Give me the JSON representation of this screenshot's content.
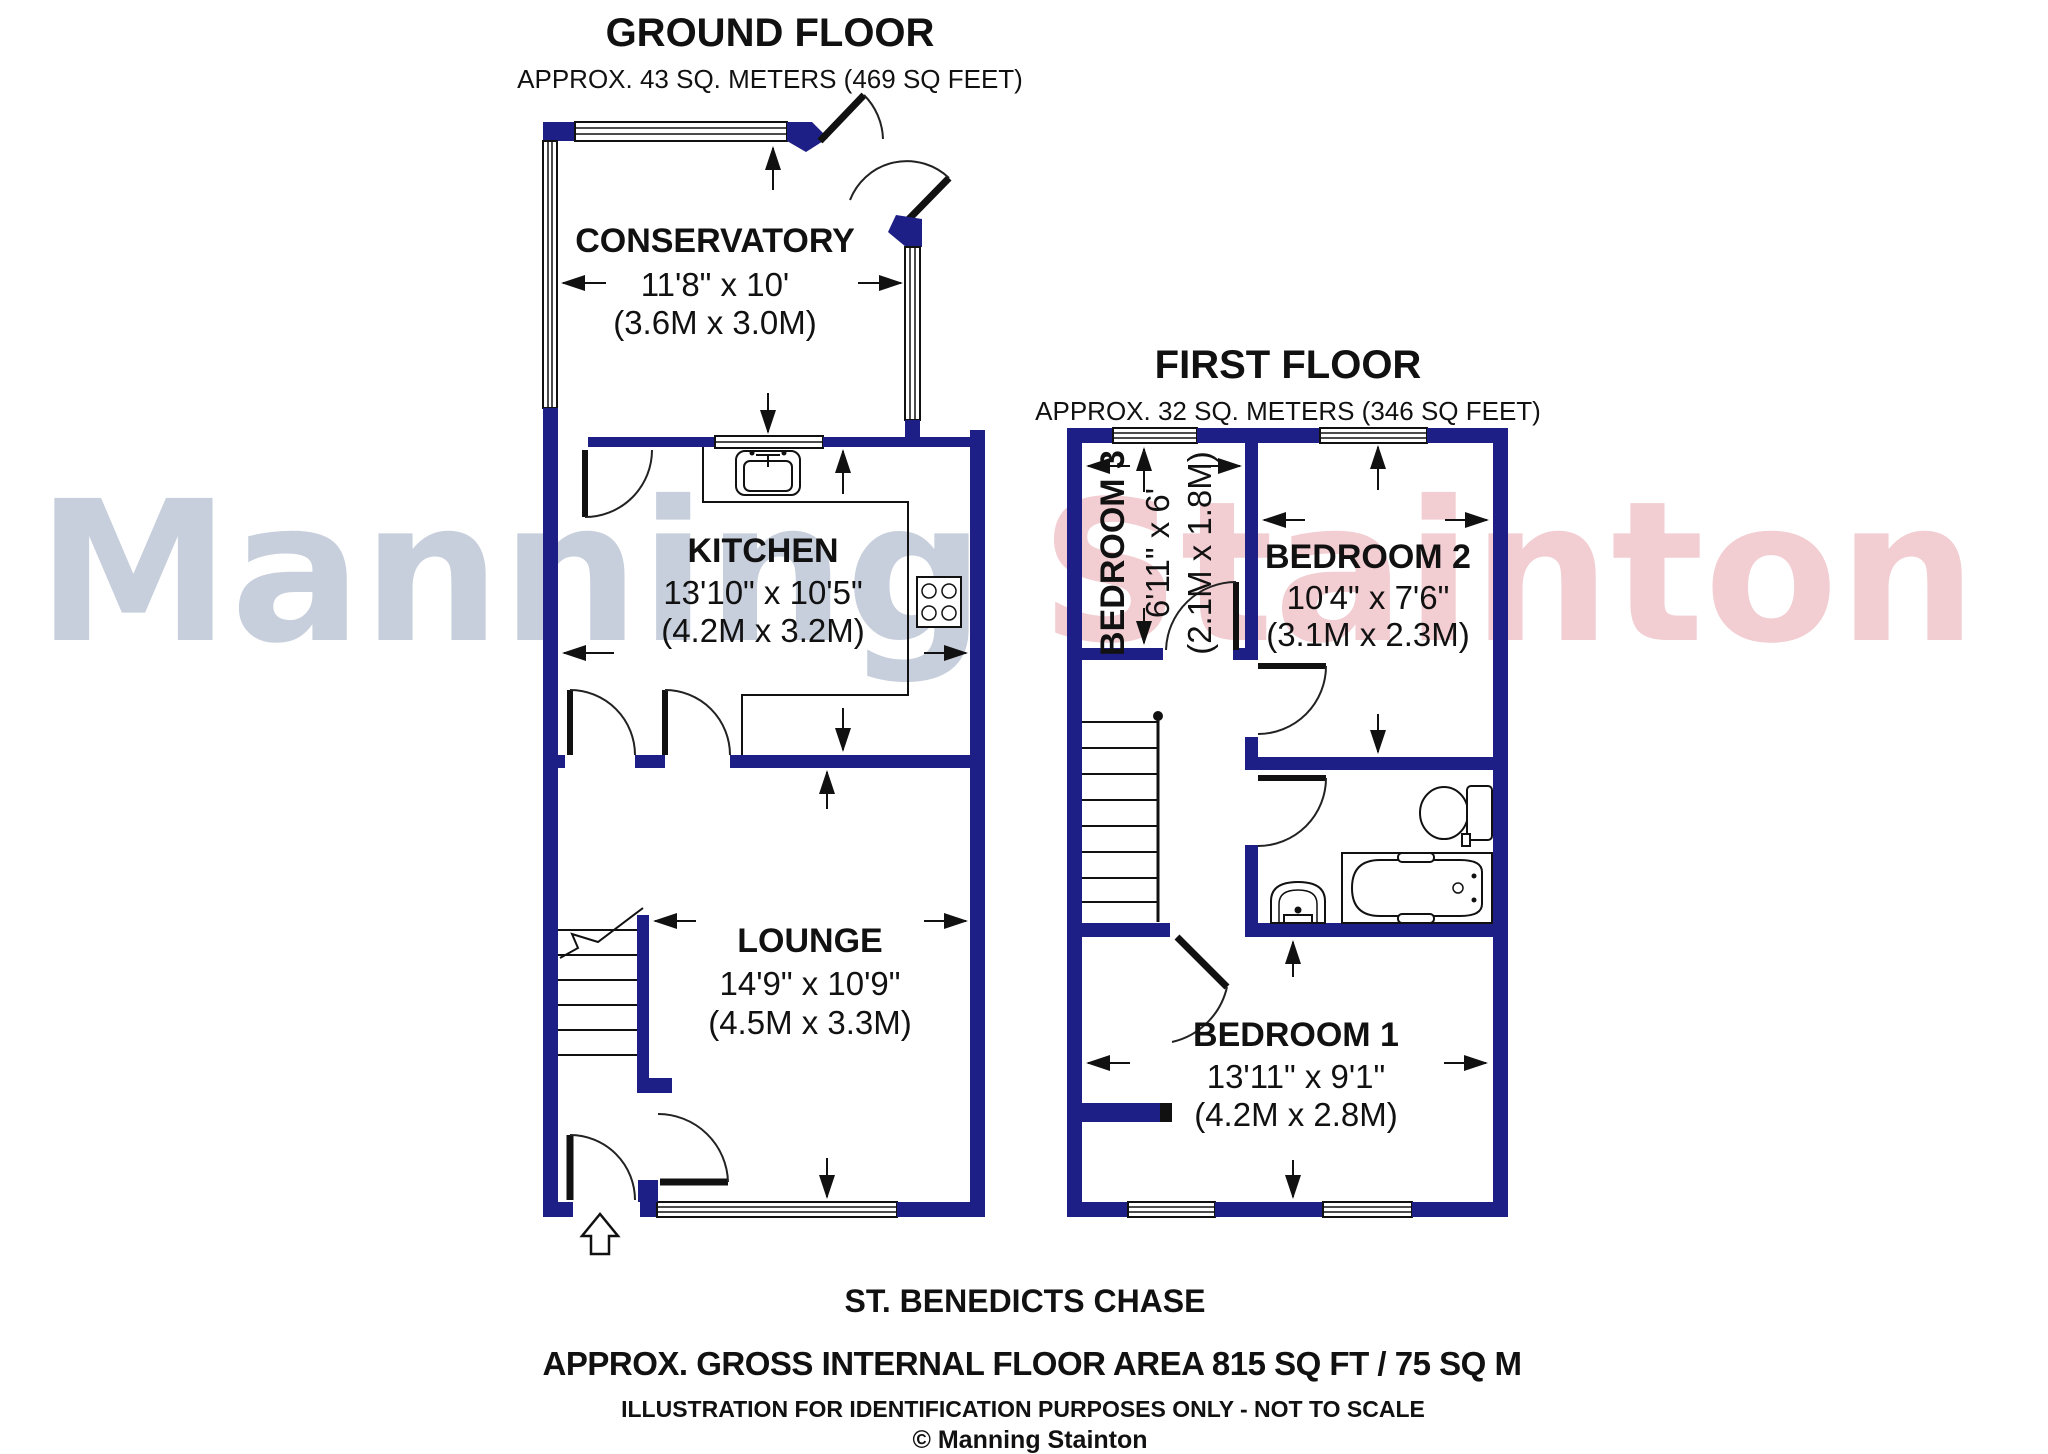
{
  "watermark": {
    "first": "Manning",
    "second": "Stainton",
    "first_color": "#c8cfdc",
    "second_color": "#f2cdd2"
  },
  "ground_floor": {
    "title": "GROUND FLOOR",
    "subtitle": "APPROX. 43 SQ. METERS (469 SQ FEET)",
    "conservatory": {
      "name": "CONSERVATORY",
      "imperial": "11'8\" x 10'",
      "metric": "(3.6M x 3.0M)"
    },
    "kitchen": {
      "name": "KITCHEN",
      "imperial": "13'10\" x 10'5\"",
      "metric": "(4.2M x 3.2M)"
    },
    "lounge": {
      "name": "LOUNGE",
      "imperial": "14'9\" x 10'9\"",
      "metric": "(4.5M x 3.3M)"
    }
  },
  "first_floor": {
    "title": "FIRST FLOOR",
    "subtitle": "APPROX. 32 SQ. METERS (346 SQ FEET)",
    "bedroom1": {
      "name": "BEDROOM 1",
      "imperial": "13'11\" x 9'1\"",
      "metric": "(4.2M x 2.8M)"
    },
    "bedroom2": {
      "name": "BEDROOM 2",
      "imperial": "10'4\" x 7'6\"",
      "metric": "(3.1M x 2.3M)"
    },
    "bedroom3": {
      "name": "BEDROOM 3",
      "imperial": "6'11\" x 6'",
      "metric": "(2.1M x 1.8M)"
    }
  },
  "footer": {
    "street": "ST. BENEDICTS CHASE",
    "area": "APPROX. GROSS INTERNAL FLOOR AREA 815 SQ FT / 75 SQ M",
    "disclaimer": "ILLUSTRATION FOR IDENTIFICATION PURPOSES ONLY - NOT TO SCALE",
    "copyright": "© Manning Stainton"
  },
  "colors": {
    "wall": "#1e1e87"
  }
}
